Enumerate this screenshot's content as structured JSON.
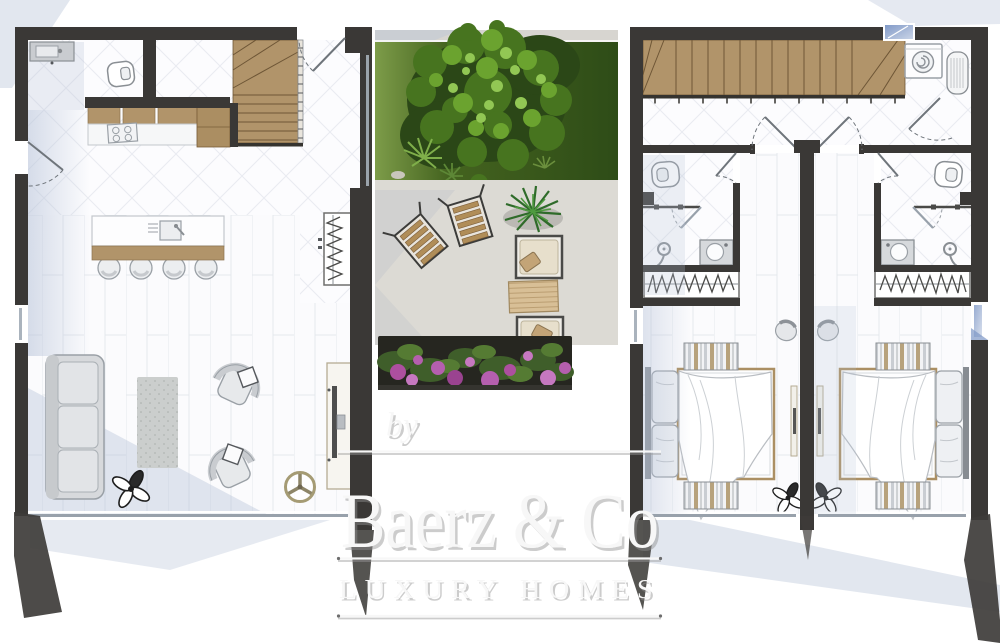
{
  "watermark": {
    "prefix": "by",
    "brand": "Baerz & Co",
    "tagline": "LUXURY HOMES"
  },
  "plans": {
    "ground_floor": {
      "position": "left",
      "rooms": [
        "bathroom",
        "storage",
        "staircase",
        "kitchen",
        "living-dining-room",
        "terrace"
      ],
      "furniture": [
        "washbasin",
        "toilet",
        "kitchen-counter",
        "stove",
        "tall-cabinet",
        "kitchen-island",
        "island-sink",
        "bar-stool",
        "bar-stool",
        "bar-stool",
        "bar-stool",
        "coat-wardrobe",
        "sofa",
        "rug",
        "armchair",
        "armchair",
        "plant",
        "ceiling-fan",
        "tv-console"
      ]
    },
    "courtyard": {
      "position": "center",
      "zones": [
        "garden",
        "patio",
        "flower-bed",
        "walkway"
      ],
      "items": [
        "tree",
        "palm-shrub",
        "palm-shrub",
        "grass-tuft",
        "rock",
        "folding-chair",
        "folding-chair",
        "potted-palm",
        "lounge-chair",
        "outdoor-mat",
        "lounge-chair",
        "bougainvillea-bed"
      ]
    },
    "first_floor": {
      "position": "right",
      "mirrored_units": true,
      "rooms": [
        "staircase",
        "landing",
        "laundry-corner",
        "bathroom",
        "wardrobe",
        "bedroom",
        "bathroom",
        "wardrobe",
        "bedroom",
        "terrace"
      ],
      "furniture": [
        "washing-machine",
        "water-heater",
        "toilet",
        "shower",
        "washbasin",
        "wardrobe-hangers",
        "double-bed",
        "pillows",
        "runner-rug",
        "runner-rug",
        "armchair",
        "plant",
        "tv-panel",
        "toilet",
        "shower",
        "washbasin",
        "wardrobe-hangers",
        "double-bed",
        "pillows",
        "runner-rug",
        "runner-rug",
        "armchair",
        "plant",
        "tv-panel"
      ]
    }
  },
  "colors": {
    "wall": "#3a3836",
    "wood": "#b1946a",
    "wood_dark": "#6e5636",
    "floor": "#fbfbfd",
    "grass_dark": "#2e4c17",
    "grass_light": "#7d9c49",
    "tree_mid": "#47741f",
    "tree_light": "#6ba32f",
    "patio": "#dcdad4",
    "flower_purple": "#b55fae",
    "foliage": "#4c6b33",
    "shadow_blue": "#b6c2d8",
    "cushion_tan": "#c3a477",
    "fixture_outline": "#8a8f94",
    "watermark": "#f7f7f7"
  }
}
